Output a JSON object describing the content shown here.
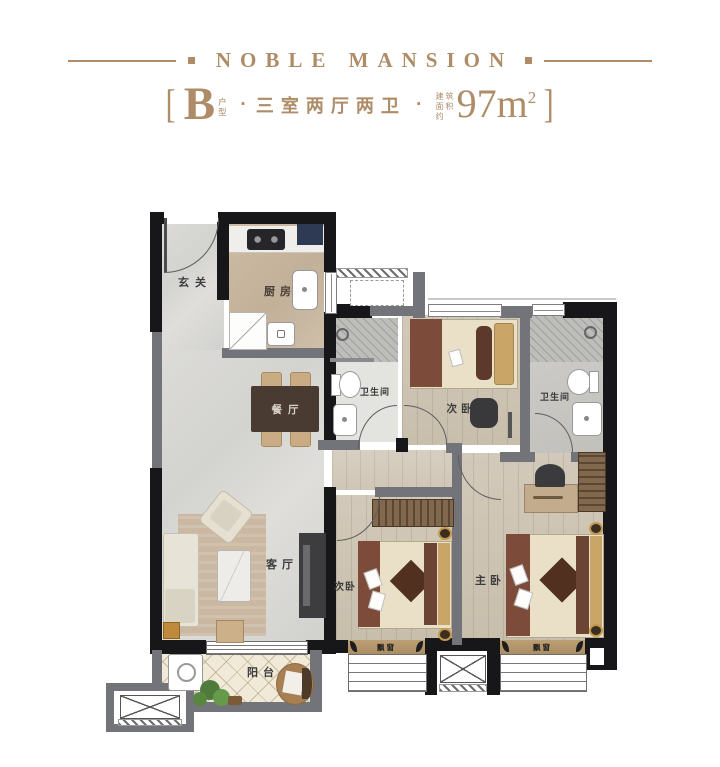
{
  "header": {
    "brand": "NOBLE MANSION",
    "bracket_left": "[",
    "bracket_right": "]",
    "unit_letter": "B",
    "unit_label": "户型",
    "separator": "·",
    "layout_text": "三室两厅两卫",
    "area_label": "建筑面积约",
    "area_value": "97m",
    "area_exponent": "2"
  },
  "rooms": {
    "entry": {
      "label": "玄关"
    },
    "kitchen": {
      "label": "厨房"
    },
    "dining": {
      "label": "餐厅"
    },
    "living": {
      "label": "客厅"
    },
    "bathroom_main": {
      "label": "卫生间"
    },
    "bathroom_master": {
      "label": "卫生间"
    },
    "bedroom_second_top": {
      "label": "次卧"
    },
    "bedroom_second_bottom": {
      "label": "次卧"
    },
    "bedroom_master": {
      "label": "主卧"
    },
    "balcony": {
      "label": "阳台"
    },
    "bay_window_left": {
      "label": "飘窗"
    },
    "bay_window_right": {
      "label": "飘窗"
    }
  },
  "colors": {
    "accent_bronze": "#ae8c68",
    "wall_dark": "#17171a",
    "wall_gray": "#73737a",
    "floor_marble": "#d8d8d5",
    "floor_wood": "#cdc3b3",
    "floor_kitchen": "#c6b49d",
    "floor_tile_bath": "#bcbcb8",
    "floor_balcony_tile": "#f1ead9",
    "bay_sill_tan": "#b69a72",
    "furniture_dark_wood": "#493b32",
    "bed_linen": "#eae0c7",
    "bed_headboard": "#7c4b39",
    "pillow_tan": "#c9a568",
    "accent_navy": "#2e3a53",
    "accent_gold": "#c4923f",
    "plant_green": "#4e7a3c"
  }
}
